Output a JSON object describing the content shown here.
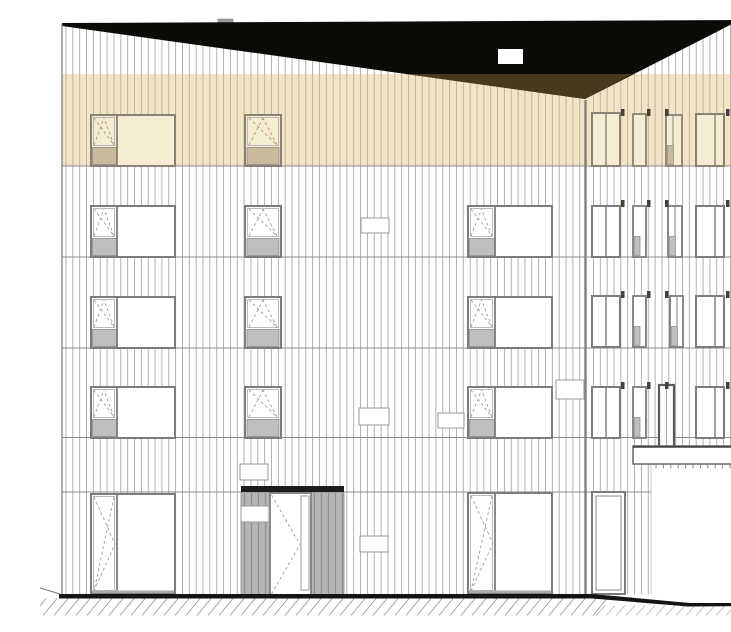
{
  "title": "building-facade-elevation",
  "canvas": {
    "width": 731,
    "height": 600,
    "background": "#ffffff"
  },
  "palette": {
    "background": "#ffffff",
    "roof_black": "#0d0b07",
    "roof_shadow": "#473a1e",
    "band": "#f2e4c7",
    "band_line": "#bcae90",
    "band_glass": "#f6ebd3",
    "band_sill": "#c8ba9b",
    "band_frame": "#8a8172",
    "band_symbol": "#a79878",
    "cladding_line": "#a9a9a9",
    "floor_line": "#8c8c8c",
    "frame": "#7c7c7c",
    "glass": "#ffffff",
    "sill": "#bfbfbf",
    "sill_border": "#8a8a8a",
    "symbol": "#9e9e9e",
    "tag": "#45403a",
    "panel": "#b5b5b5",
    "panel_line": "#8f8f8f",
    "header_black": "#1c1c1c",
    "door_frame": "#5a5a5a",
    "ground_black": "#151515",
    "hatch": "#9a9a9a",
    "hatch_light": "#b9b9b9",
    "vent_border": "#999999",
    "canopy_border": "#666666",
    "edge": "#777777",
    "divider": "#808080",
    "recess_edge": "#c9c9c9",
    "inner_frame": "#aaaaaa"
  },
  "roof": {
    "black_polygon": [
      [
        22,
        7
      ],
      [
        700,
        4
      ],
      [
        545,
        83
      ],
      [
        22,
        10
      ]
    ],
    "shadow_polygon": [
      [
        366,
        58
      ],
      [
        592,
        58
      ],
      [
        545,
        83
      ]
    ],
    "vent": {
      "x": 458,
      "y": 33,
      "w": 25,
      "h": 15
    },
    "tab": {
      "x": 178,
      "y": 3,
      "w": 15,
      "h": 5
    },
    "valley_x": 545,
    "left_y0": 10,
    "left_x0": 22,
    "left_slope": 0.13958,
    "right_slope": 0.5097,
    "valley_y": 83
  },
  "accent_band": {
    "x": 22,
    "y": 58,
    "w": 678,
    "h": 92
  },
  "cladding": {
    "x0": 26,
    "x1": 698,
    "step": 6.85,
    "y_bottom_main": 578,
    "recess_x": 610.5,
    "y_bottom_recess": 430,
    "band_y0": 58,
    "band_y1": 150,
    "skip_x": 545,
    "skip_r": 3
  },
  "floor_lines": [
    {
      "y": 150,
      "x0": 22,
      "x1": 700
    },
    {
      "y": 241,
      "x0": 22,
      "x1": 700
    },
    {
      "y": 332,
      "x0": 22,
      "x1": 700
    },
    {
      "y": 421.5,
      "x0": 22,
      "x1": 728
    },
    {
      "y": 476,
      "x0": 22,
      "x1": 611
    }
  ],
  "edges": [
    {
      "x": 22,
      "y0": 8,
      "y1": 578,
      "w": 1.2,
      "color_key": "edge"
    },
    {
      "x": 700,
      "y0": 4,
      "y1": 430,
      "w": 1.2,
      "color_key": "edge"
    },
    {
      "x": 545.5,
      "y0": 84,
      "y1": 578,
      "w": 2.4,
      "color_key": "divider"
    },
    {
      "x": 611,
      "y0": 448,
      "y1": 578,
      "w": 1.0,
      "color_key": "recess_edge"
    }
  ],
  "windows": [
    {
      "id": "top-left-living",
      "kind": "casement_fixed",
      "tone": "tan",
      "x": 51,
      "y": 99,
      "w": 84,
      "h": 51,
      "cw": 26
    },
    {
      "id": "top-left-small",
      "kind": "casement",
      "tone": "tan",
      "x": 205,
      "y": 99,
      "w": 36,
      "h": 51
    },
    {
      "id": "top-right-1",
      "kind": "split",
      "tone": "tan",
      "x": 552,
      "y": 97,
      "w": 28,
      "h": 53,
      "d": 14
    },
    {
      "id": "top-right-2",
      "kind": "narrow",
      "tone": "tan",
      "x": 593,
      "y": 98,
      "w": 13,
      "h": 52,
      "sub": false
    },
    {
      "id": "top-right-3",
      "kind": "narrow3",
      "tone": "tan",
      "x": 626,
      "y": 99,
      "w": 16,
      "h": 51
    },
    {
      "id": "top-right-4",
      "kind": "split",
      "tone": "tan",
      "x": 656,
      "y": 98,
      "w": 28,
      "h": 52,
      "d": 19
    },
    {
      "id": "f3-left-living",
      "kind": "casement_fixed",
      "tone": "std",
      "x": 51,
      "y": 190,
      "w": 84,
      "h": 51,
      "cw": 26
    },
    {
      "id": "f3-left-small",
      "kind": "casement",
      "tone": "std",
      "x": 205,
      "y": 190,
      "w": 36,
      "h": 51
    },
    {
      "id": "f3-mid-living",
      "kind": "casement_fixed",
      "tone": "std",
      "x": 428,
      "y": 190,
      "w": 84,
      "h": 51,
      "cw": 27
    },
    {
      "id": "f3-right-1",
      "kind": "split",
      "tone": "std",
      "x": 552,
      "y": 190,
      "w": 28,
      "h": 51,
      "d": 14
    },
    {
      "id": "f3-right-2",
      "kind": "narrow",
      "tone": "std",
      "x": 593,
      "y": 190,
      "w": 13,
      "h": 51,
      "sub": true
    },
    {
      "id": "f3-right-3",
      "kind": "narrow3",
      "tone": "std",
      "x": 628,
      "y": 190,
      "w": 14,
      "h": 51
    },
    {
      "id": "f3-right-4",
      "kind": "split",
      "tone": "std",
      "x": 656,
      "y": 190,
      "w": 28,
      "h": 51,
      "d": 19
    },
    {
      "id": "f2-left-living",
      "kind": "casement_fixed",
      "tone": "std",
      "x": 51,
      "y": 281,
      "w": 84,
      "h": 51,
      "cw": 26
    },
    {
      "id": "f2-left-small",
      "kind": "casement",
      "tone": "std",
      "x": 205,
      "y": 281,
      "w": 36,
      "h": 51
    },
    {
      "id": "f2-mid-living",
      "kind": "casement_fixed",
      "tone": "std",
      "x": 428,
      "y": 281,
      "w": 84,
      "h": 51,
      "cw": 27
    },
    {
      "id": "f2-right-1",
      "kind": "split",
      "tone": "std",
      "x": 552,
      "y": 280,
      "w": 28,
      "h": 51,
      "d": 14
    },
    {
      "id": "f2-right-2",
      "kind": "narrow",
      "tone": "std",
      "x": 593,
      "y": 280,
      "w": 13,
      "h": 51,
      "sub": true
    },
    {
      "id": "f2-right-3",
      "kind": "narrow3",
      "tone": "std",
      "x": 630,
      "y": 280,
      "w": 13,
      "h": 51
    },
    {
      "id": "f2-right-4",
      "kind": "split",
      "tone": "std",
      "x": 656,
      "y": 280,
      "w": 28,
      "h": 51,
      "d": 19
    },
    {
      "id": "f1-left-living",
      "kind": "casement_fixed",
      "tone": "std",
      "x": 51,
      "y": 371,
      "w": 84,
      "h": 51,
      "cw": 26
    },
    {
      "id": "f1-left-small",
      "kind": "casement",
      "tone": "std",
      "x": 205,
      "y": 371,
      "w": 36,
      "h": 51
    },
    {
      "id": "f1-mid-living",
      "kind": "casement_fixed",
      "tone": "std",
      "x": 428,
      "y": 371,
      "w": 84,
      "h": 51,
      "cw": 27
    },
    {
      "id": "f1-right-1",
      "kind": "split",
      "tone": "std",
      "x": 552,
      "y": 371,
      "w": 28,
      "h": 51,
      "d": 14
    },
    {
      "id": "f1-right-2",
      "kind": "narrow",
      "tone": "std",
      "x": 593,
      "y": 371,
      "w": 13,
      "h": 51,
      "sub": true
    },
    {
      "id": "f1-terrace-door",
      "kind": "door_tall",
      "tone": "std",
      "x": 619,
      "y": 369,
      "w": 15,
      "h": 64
    },
    {
      "id": "f1-right-4",
      "kind": "split",
      "tone": "std",
      "x": 656,
      "y": 371,
      "w": 28,
      "h": 51,
      "d": 19
    },
    {
      "id": "gf-left-glass-door",
      "kind": "glass_door",
      "tone": "std",
      "x": 51,
      "y": 478,
      "w": 84,
      "h": 100,
      "leaf": 26
    },
    {
      "id": "gf-mid-glass-door",
      "kind": "glass_door",
      "tone": "std",
      "x": 428,
      "y": 477,
      "w": 84,
      "h": 101,
      "leaf": 27
    },
    {
      "id": "gf-right-window",
      "kind": "double_frame",
      "tone": "std",
      "x": 552,
      "y": 476,
      "w": 33,
      "h": 102
    }
  ],
  "window_tags": {
    "xs": [
      581,
      607,
      625,
      686
    ],
    "ys": [
      93,
      184,
      275,
      366
    ],
    "w": 3.5,
    "h": 7
  },
  "vents": [
    {
      "x": 321,
      "y": 202,
      "w": 28,
      "h": 15
    },
    {
      "x": 319,
      "y": 392,
      "w": 30,
      "h": 17
    },
    {
      "x": 398,
      "y": 397,
      "w": 26,
      "h": 15
    },
    {
      "x": 516,
      "y": 364,
      "w": 28,
      "h": 19
    },
    {
      "x": 320,
      "y": 520,
      "w": 28,
      "h": 16
    }
  ],
  "signs": [
    {
      "x": 200,
      "y": 448,
      "w": 28,
      "h": 16
    },
    {
      "x": 201,
      "y": 490,
      "w": 28,
      "h": 16
    }
  ],
  "entrance": {
    "header": {
      "x": 201,
      "y": 470,
      "w": 103,
      "h": 6
    },
    "panels": [
      {
        "x": 201,
        "y": 476,
        "w": 29,
        "h": 104
      },
      {
        "x": 271,
        "y": 476,
        "w": 33,
        "h": 104
      }
    ],
    "door": {
      "x": 230,
      "y": 477,
      "w": 41,
      "h": 103
    },
    "lite": {
      "x": 261,
      "y": 480,
      "w": 8,
      "h": 94
    },
    "stripe_step": 7
  },
  "canopy": {
    "x": 593,
    "y": 430,
    "w": 135,
    "h": 18,
    "tick_y": 448,
    "tick_h": 4.5,
    "tick_x0": 616,
    "tick_x1": 727,
    "tick_step": 7.4
  },
  "ground": {
    "bar": {
      "x": 19,
      "y": 578,
      "w": 533,
      "h": 4.5
    },
    "slope_polygon": [
      [
        552,
        578
      ],
      [
        650,
        587
      ],
      [
        731,
        587
      ],
      [
        731,
        590
      ],
      [
        648,
        590.5
      ],
      [
        552,
        582.5
      ]
    ],
    "terrain_line": {
      "x0": 0,
      "y0": 572,
      "x1": 20,
      "y1": 578
    },
    "hatch_left": {
      "x0": -8,
      "x1": 556,
      "step": 11,
      "y0": 599.5,
      "y1": 582.5,
      "dx": 14
    },
    "hatch_right": {
      "x0": 556,
      "x1": 734,
      "step": 10,
      "y0": 599.5,
      "y1": 589.5,
      "dx": 9
    }
  }
}
